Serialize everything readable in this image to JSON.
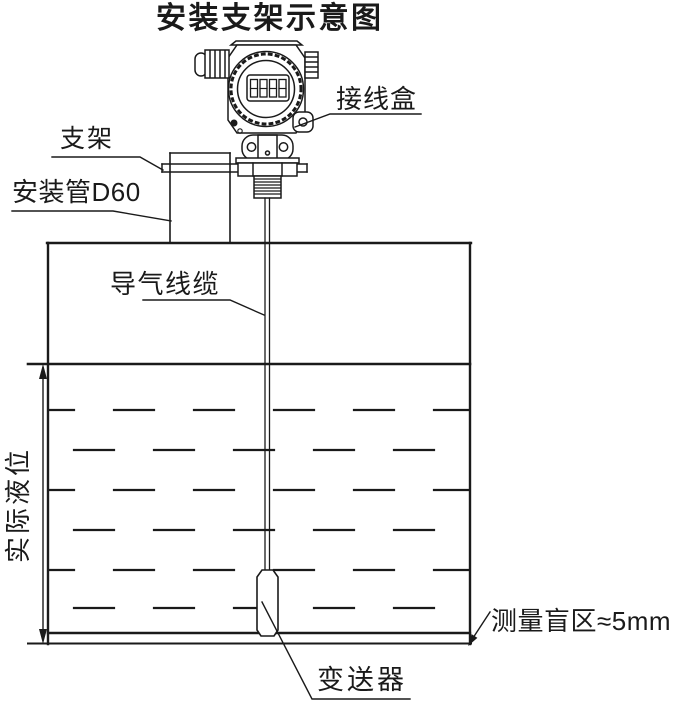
{
  "title": "安装支架示意图",
  "labels": {
    "junction_box": "接线盒",
    "bracket": "支架",
    "mounting_pipe": "安装管D60",
    "air_cable": "导气线缆",
    "actual_level": "实际液位",
    "blind_zone": "测量盲区≈5mm",
    "transmitter": "变送器"
  },
  "display_value": "8888",
  "colors": {
    "line": "#1a1a1a",
    "background": "#ffffff"
  }
}
